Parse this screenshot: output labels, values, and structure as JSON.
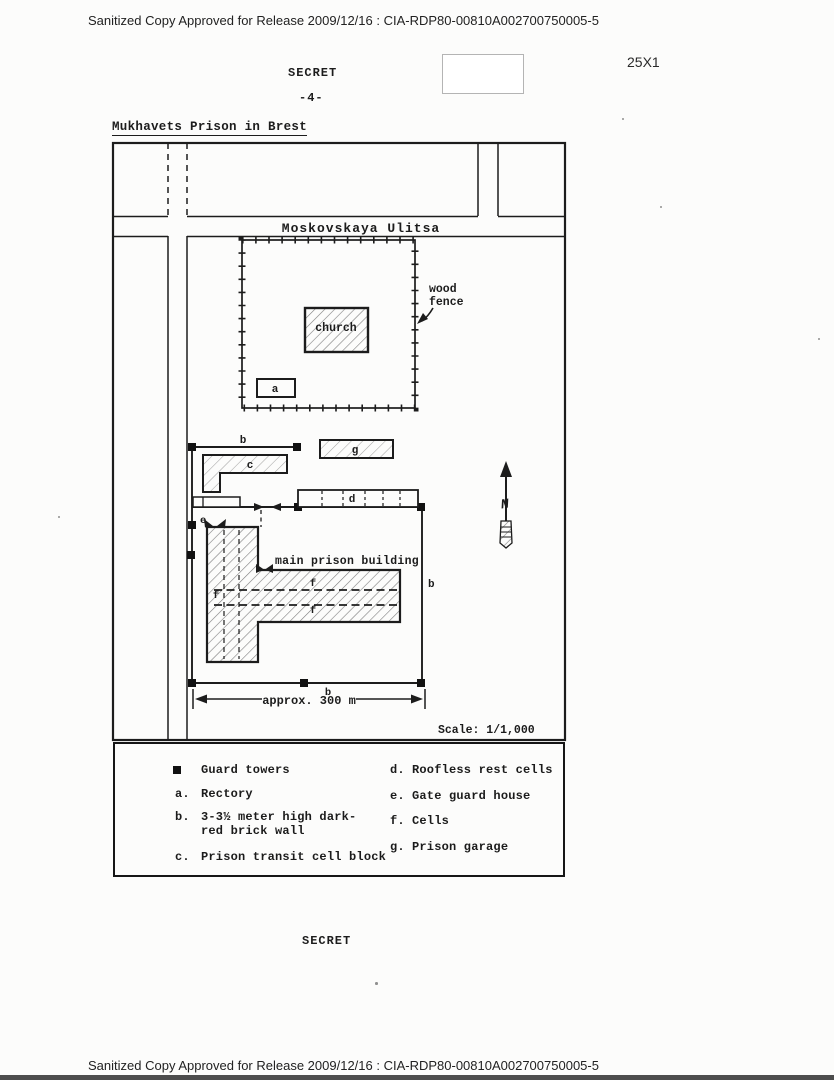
{
  "colors": {
    "ink": "#1c1c1c",
    "paper": "#fcfcfb",
    "redaction_border": "#b4b4b4",
    "bottom_bar": "#4d4d4d"
  },
  "header": {
    "sanitized_line": "Sanitized Copy Approved for Release 2009/12/16 : CIA-RDP80-00810A002700750005-5",
    "classification": "SECRET",
    "page_number": "-4-",
    "margin_note": "25X1"
  },
  "title": "Mukhavets Prison in Brest",
  "map": {
    "street_label": "Moskovskaya Ulitsa",
    "wood_fence_line1": "wood",
    "wood_fence_line2": "fence",
    "church_label": "church",
    "rectory_label": "a",
    "wall_label_top": "b",
    "wall_label_right": "b",
    "wall_label_bottom": "b",
    "transit_block_label": "c",
    "rest_cells_label": "d",
    "gate_house_label": "e",
    "cells_label_1": "f",
    "cells_label_2": "f",
    "cells_label_3": "f",
    "garage_label": "g",
    "main_building_label": "main prison building",
    "north_label": "N",
    "dimension_label": "approx. 300 m",
    "scale_label": "Scale: 1/1,000"
  },
  "legend": {
    "left": [
      {
        "key": "",
        "label": "Guard towers"
      },
      {
        "key": "a.",
        "label": "Rectory"
      },
      {
        "key": "b.",
        "label_line1": "3-3½ meter high dark-",
        "label_line2": "red brick wall"
      },
      {
        "key": "c.",
        "label": "Prison transit cell block"
      }
    ],
    "right": [
      {
        "key": "d.",
        "label": "Roofless rest cells"
      },
      {
        "key": "e.",
        "label": "Gate guard house"
      },
      {
        "key": "f.",
        "label": "Cells"
      },
      {
        "key": "g.",
        "label": "Prison garage"
      }
    ]
  },
  "footer": {
    "classification": "SECRET",
    "sanitized_line": "Sanitized Copy Approved for Release 2009/12/16 : CIA-RDP80-00810A002700750005-5"
  }
}
